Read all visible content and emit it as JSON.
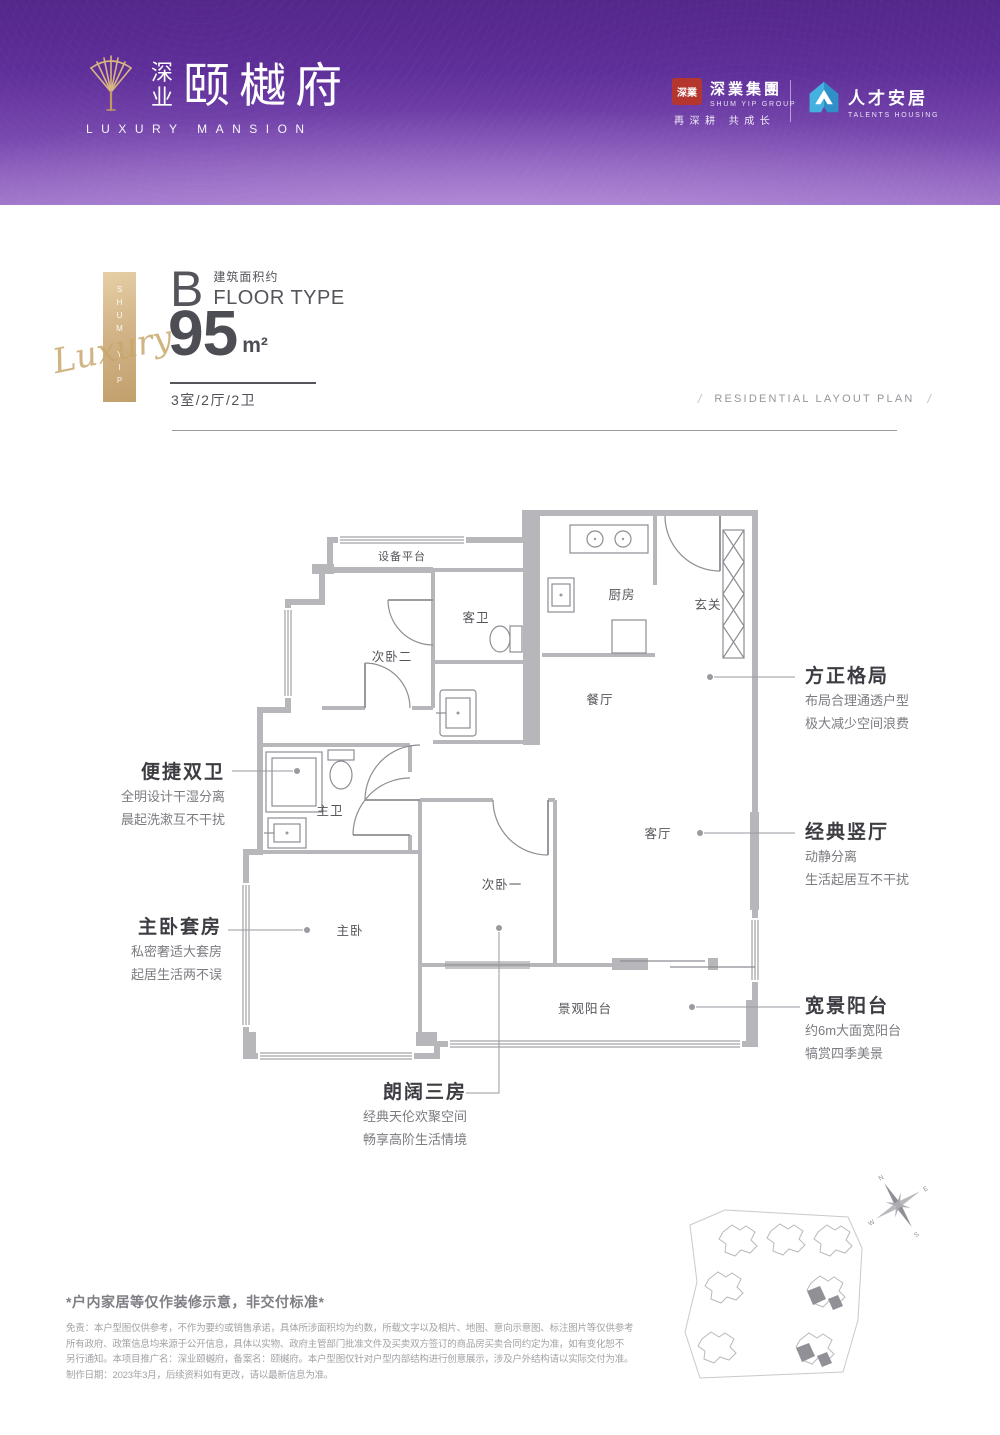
{
  "header": {
    "brand_cn_prefix_top": "深",
    "brand_cn_prefix_bottom": "业",
    "brand_cn": "颐樾府",
    "brand_en": "LUXURY MANSION",
    "group_seal": "深業",
    "group_cn": "深業集團",
    "group_en": "SHUM YIP GROUP",
    "group_slogan": "再深耕 共成长",
    "talents_cn": "人才安居",
    "talents_en": "TALENTS HOUSING"
  },
  "unit": {
    "type_letter": "B",
    "area_note": "建筑面积约",
    "type_label": "FLOOR TYPE",
    "area_value": "95",
    "area_unit": "m²",
    "layout_spec": "3室/2厅/2卫",
    "plan_caption": "RESIDENTIAL LAYOUT PLAN",
    "slash": "/",
    "ribbon_vertical": "SHUM YIP",
    "ribbon_script": "Luxury"
  },
  "plan_rooms": {
    "equipment": "设备平台",
    "bedroom2": "次卧二",
    "guest_bath": "客卫",
    "kitchen": "厨房",
    "foyer": "玄关",
    "dining": "餐厅",
    "master_bath": "主卫",
    "living": "客厅",
    "bedroom1": "次卧一",
    "master_bedroom": "主卧",
    "balcony": "景观阳台"
  },
  "callouts": {
    "square": {
      "title": "方正格局",
      "line1": "布局合理通透户型",
      "line2": "极大减少空间浪费"
    },
    "hall": {
      "title": "经典竖厅",
      "line1": "动静分离",
      "line2": "生活起居互不干扰"
    },
    "balcony": {
      "title": "宽景阳台",
      "line1": "约6m大面宽阳台",
      "line2": "犒赏四季美景"
    },
    "bath": {
      "title": "便捷双卫",
      "line1": "全明设计干湿分离",
      "line2": "晨起洗漱互不干扰"
    },
    "master": {
      "title": "主卧套房",
      "line1": "私密奢适大套房",
      "line2": "起居生活两不误"
    },
    "rooms3": {
      "title": "朗阔三房",
      "line1": "经典天伦欢聚空间",
      "line2": "畅享高阶生活情境"
    }
  },
  "compass": {
    "n": "N",
    "e": "E",
    "s": "S",
    "w": "W"
  },
  "disclaimer": {
    "title": "*户内家居等仅作装修示意，非交付标准*",
    "line1": "免责：本户型图仅供参考，不作为要约或销售承诺，具体所涉面积均为约数，所载文字以及相片、地图、意向示意图、标注图片等仅供参考",
    "line2": "所有政府、政策信息均来源于公开信息，具体以实物、政府主管部门批准文件及买卖双方签订的商品房买卖合同约定为准，如有变化恕不",
    "line3": "另行通知。本项目推广名：深业颐樾府，备案名：颐樾府。本户型图仅针对户型内部结构进行创意展示，涉及户外结构请以实际交付为准。",
    "line4": "制作日期：2023年3月，后续资料如有更改，请以最新信息为准。"
  },
  "colors": {
    "header_top": "#53278a",
    "header_bottom": "#9a6fc6",
    "gold": "#cfae7d",
    "seal_red": "#b5362e",
    "talents_blue": "#2f8fc6",
    "wall_gray": "#b7b6bb",
    "ink": "#4d4d54"
  }
}
